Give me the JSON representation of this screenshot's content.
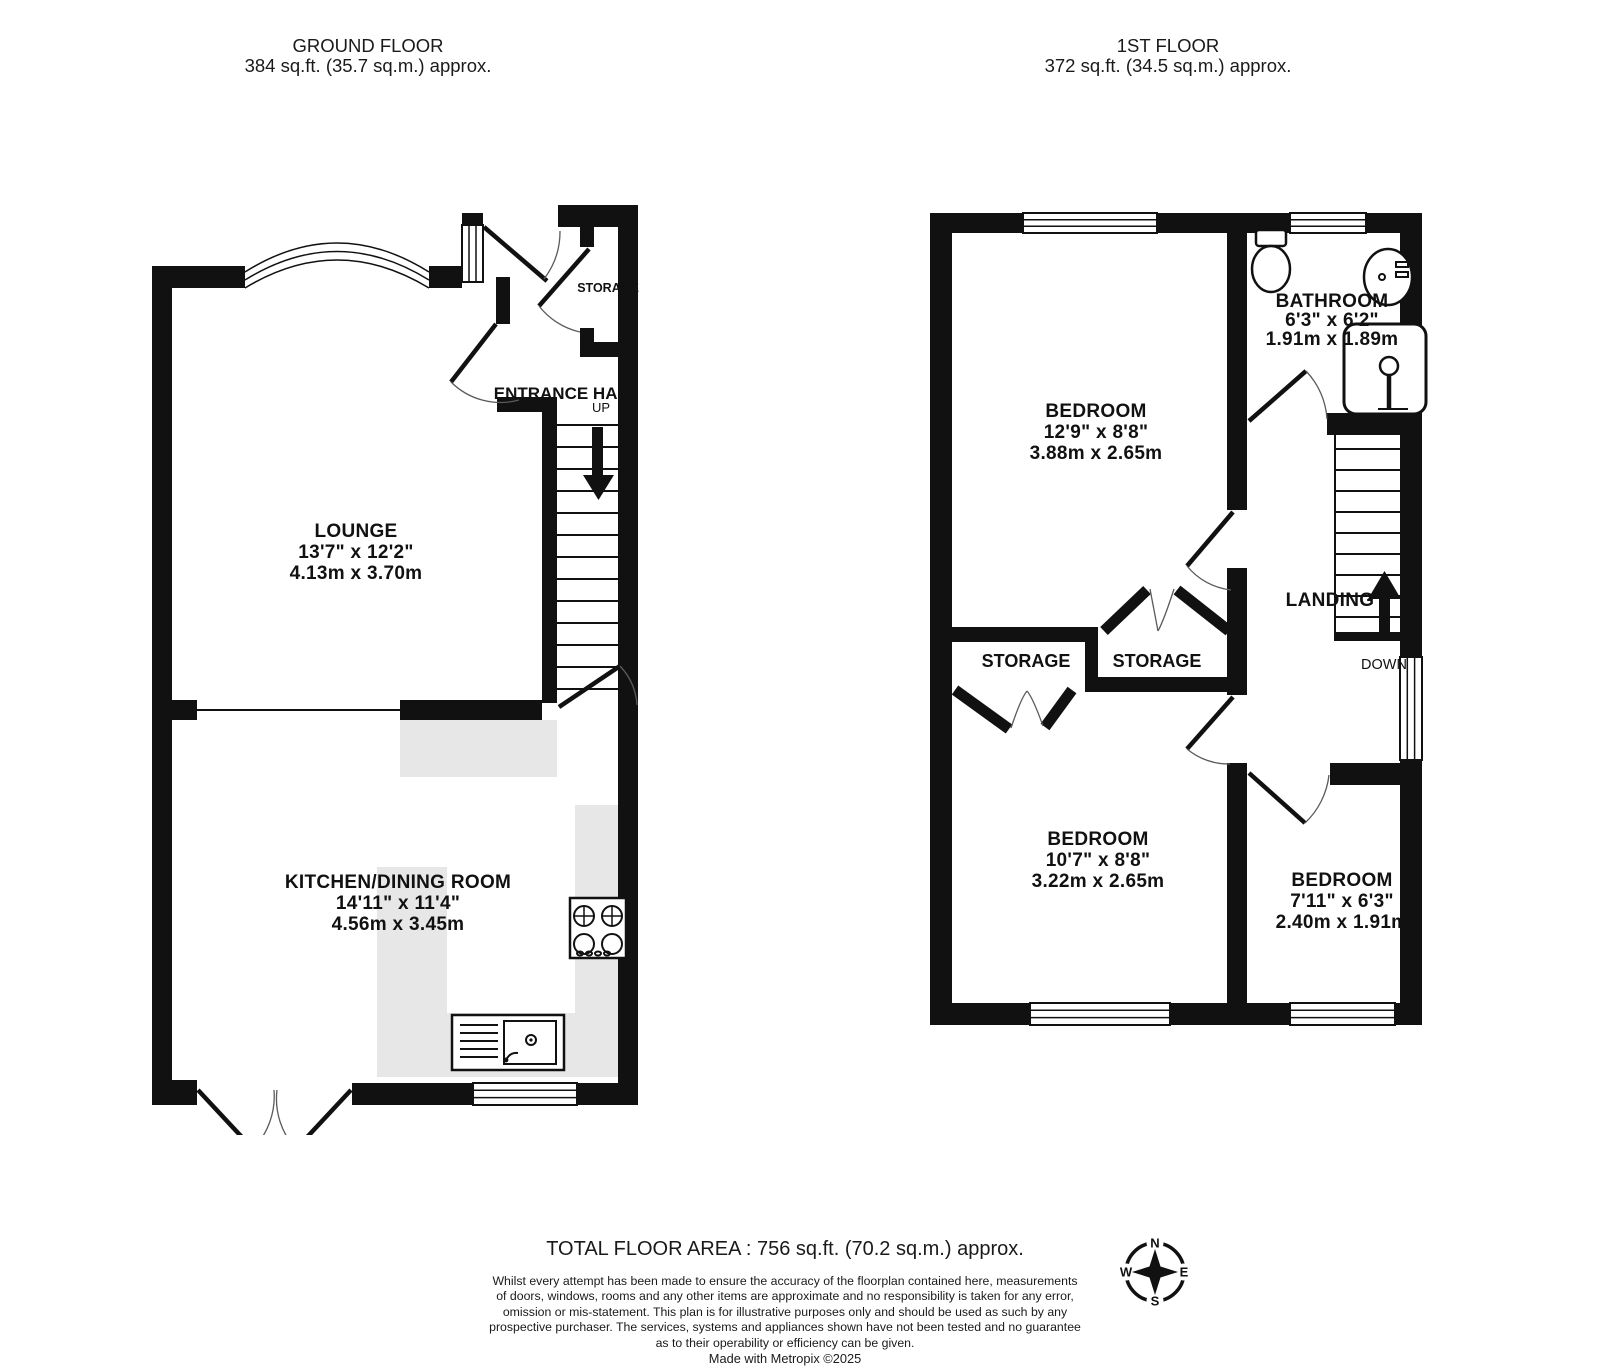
{
  "page": {
    "background": "#ffffff",
    "wall_color": "#111111",
    "counter_color": "#e7e7e7"
  },
  "ground_floor": {
    "title": "GROUND FLOOR",
    "area": "384 sq.ft. (35.7 sq.m.) approx.",
    "lounge_name": "LOUNGE",
    "lounge_imperial": "13'7\" x 12'2\"",
    "lounge_metric": "4.13m x 3.70m",
    "kitchen_name": "KITCHEN/DINING ROOM",
    "kitchen_imperial": "14'11\" x 11'4\"",
    "kitchen_metric": "4.56m x 3.45m",
    "entrance_hall": "ENTRANCE HALL",
    "up": "UP",
    "storage": "STORAGE"
  },
  "first_floor": {
    "title": "1ST FLOOR",
    "area": "372 sq.ft. (34.5 sq.m.) approx.",
    "bedroom1_name": "BEDROOM",
    "bedroom1_imperial": "12'9\" x 8'8\"",
    "bedroom1_metric": "3.88m x 2.65m",
    "bathroom_name": "BATHROOM",
    "bathroom_imperial": "6'3\" x 6'2\"",
    "bathroom_metric": "1.91m x 1.89m",
    "bedroom2_name": "BEDROOM",
    "bedroom2_imperial": "10'7\" x 8'8\"",
    "bedroom2_metric": "3.22m x 2.65m",
    "bedroom3_name": "BEDROOM",
    "bedroom3_imperial": "7'11\" x 6'3\"",
    "bedroom3_metric": "2.40m x 1.91m",
    "storage_left": "STORAGE",
    "storage_mid": "STORAGE",
    "landing": "LANDING",
    "down": "DOWN"
  },
  "footer": {
    "total_area": "TOTAL FLOOR AREA : 756 sq.ft. (70.2 sq.m.) approx.",
    "disclaimer_lines": [
      "Whilst every attempt has been made to ensure the accuracy of the floorplan contained here, measurements",
      "of doors, windows, rooms and any other items are approximate and no responsibility is taken for any error,",
      "omission or mis-statement. This plan is for illustrative purposes only and should be used as such by any",
      "prospective purchaser. The services, systems and appliances shown have not been tested and no guarantee",
      "as to their operability or efficiency can be given."
    ],
    "credit": "Made with Metropix ©2025"
  },
  "compass": {
    "north": "N",
    "east": "E",
    "south": "S",
    "west": "W"
  }
}
